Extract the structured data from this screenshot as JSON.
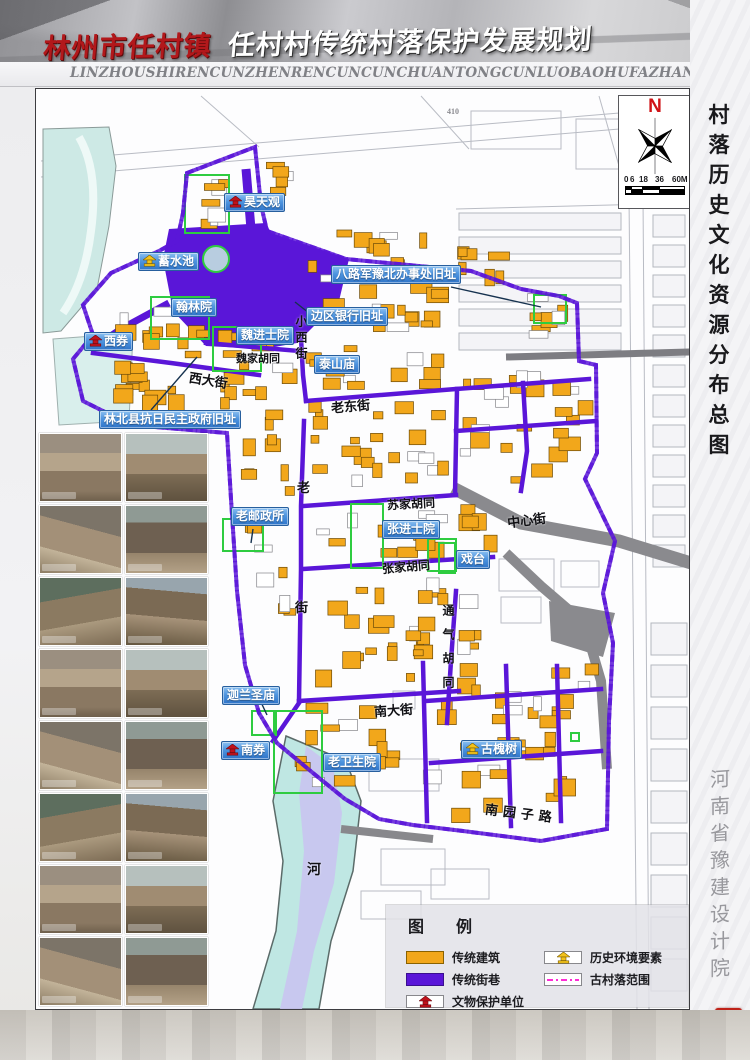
{
  "header": {
    "title_red": "林州市任村镇",
    "title_main": "任村村传统村落保护发展规划",
    "pinyin": "LINZHOUSHIRENCUNZHENRENCUNCUNCHUANTONGCUNLUOBAOHUFAZHANGUIHUA",
    "page_number": "08"
  },
  "sidebar": {
    "title": "村落历史文化资源分布总图",
    "institute": "河南省豫建设计院",
    "seal_columns": [
      "豫建",
      "规划"
    ]
  },
  "compass": {
    "north_label": "N",
    "scale_ticks": [
      "0",
      "6",
      "18",
      "36",
      "60M"
    ]
  },
  "legend": {
    "title": "图  例",
    "items": [
      {
        "label": "传统建筑",
        "swatch": "orange",
        "col": 1,
        "row": 1
      },
      {
        "label": "传统街巷",
        "swatch": "purple",
        "col": 1,
        "row": 2
      },
      {
        "label": "文物保护单位",
        "swatch": "monument-red",
        "col": 1,
        "row": 3
      },
      {
        "label": "历史环境要素",
        "swatch": "monument-yellow",
        "col": 2,
        "row": 1
      },
      {
        "label": "古村落范围",
        "swatch": "boundary",
        "col": 2,
        "row": 2
      }
    ]
  },
  "map": {
    "labels": [
      {
        "text": "昊天观",
        "x": 223,
        "y": 192,
        "icon": "red"
      },
      {
        "text": "蓄水池",
        "x": 137,
        "y": 251,
        "icon": "yellow"
      },
      {
        "text": "八路军豫北办事处旧址",
        "x": 330,
        "y": 264
      },
      {
        "text": "翰林院",
        "x": 170,
        "y": 297
      },
      {
        "text": "边区银行旧址",
        "x": 305,
        "y": 306
      },
      {
        "text": "魏进士院",
        "x": 235,
        "y": 325
      },
      {
        "text": "西券",
        "x": 83,
        "y": 331,
        "icon": "red"
      },
      {
        "text": "泰山庙",
        "x": 313,
        "y": 354
      },
      {
        "text": "林北县抗日民主政府旧址",
        "x": 98,
        "y": 409
      },
      {
        "text": "老邮政所",
        "x": 230,
        "y": 506
      },
      {
        "text": "张进士院",
        "x": 381,
        "y": 519
      },
      {
        "text": "戏台",
        "x": 455,
        "y": 549
      },
      {
        "text": "迦兰圣庙",
        "x": 221,
        "y": 685
      },
      {
        "text": "南券",
        "x": 220,
        "y": 740,
        "icon": "red"
      },
      {
        "text": "老卫生院",
        "x": 322,
        "y": 752
      },
      {
        "text": "古槐树",
        "x": 460,
        "y": 739,
        "icon": "yellow"
      }
    ],
    "streets": [
      {
        "text": "魏家胡同",
        "x": 235,
        "y": 349,
        "fs": 11
      },
      {
        "text": "西大街",
        "x": 188,
        "y": 369,
        "fs": 13,
        "rot": 9
      },
      {
        "text": "小西街",
        "x": 292,
        "y": 314,
        "fs": 12,
        "vert": 1,
        "ls": 4
      },
      {
        "text": "老东街",
        "x": 330,
        "y": 395,
        "fs": 13,
        "rot": -5
      },
      {
        "text": "老",
        "x": 296,
        "y": 476,
        "fs": 13
      },
      {
        "text": "街",
        "x": 294,
        "y": 596,
        "fs": 13
      },
      {
        "text": "苏家胡同",
        "x": 386,
        "y": 494,
        "fs": 12,
        "rot": -3
      },
      {
        "text": "中心街",
        "x": 506,
        "y": 509,
        "fs": 13,
        "rot": -7
      },
      {
        "text": "张家胡同",
        "x": 381,
        "y": 557,
        "fs": 12,
        "rot": -5
      },
      {
        "text": "南大街",
        "x": 373,
        "y": 699,
        "fs": 13,
        "rot": -4
      },
      {
        "text": "通气胡同",
        "x": 439,
        "y": 603,
        "fs": 12,
        "vert": 1,
        "ls": 12
      },
      {
        "text": "南园子路",
        "x": 484,
        "y": 802,
        "fs": 13,
        "rot": 7,
        "ls": 5
      },
      {
        "text": "河",
        "x": 306,
        "y": 858,
        "fs": 14
      },
      {
        "text": "410",
        "x": 446,
        "y": 106,
        "fs": 8,
        "color": "#8a8a90"
      }
    ]
  },
  "photos": {
    "count": 16
  },
  "colors": {
    "traditional_building": "#F2A71B",
    "traditional_street": "#5A16D8",
    "protected_outline": "#2ECC40",
    "village_boundary": "#FF2BD6",
    "label_blue": "#3B82D4",
    "monument_red": "#C1121C",
    "monument_yellow": "#F3C21A",
    "road_gray": "#8a8a8e",
    "river_teal": "#BFE7E3",
    "river_lavender": "#C9C4EF"
  }
}
